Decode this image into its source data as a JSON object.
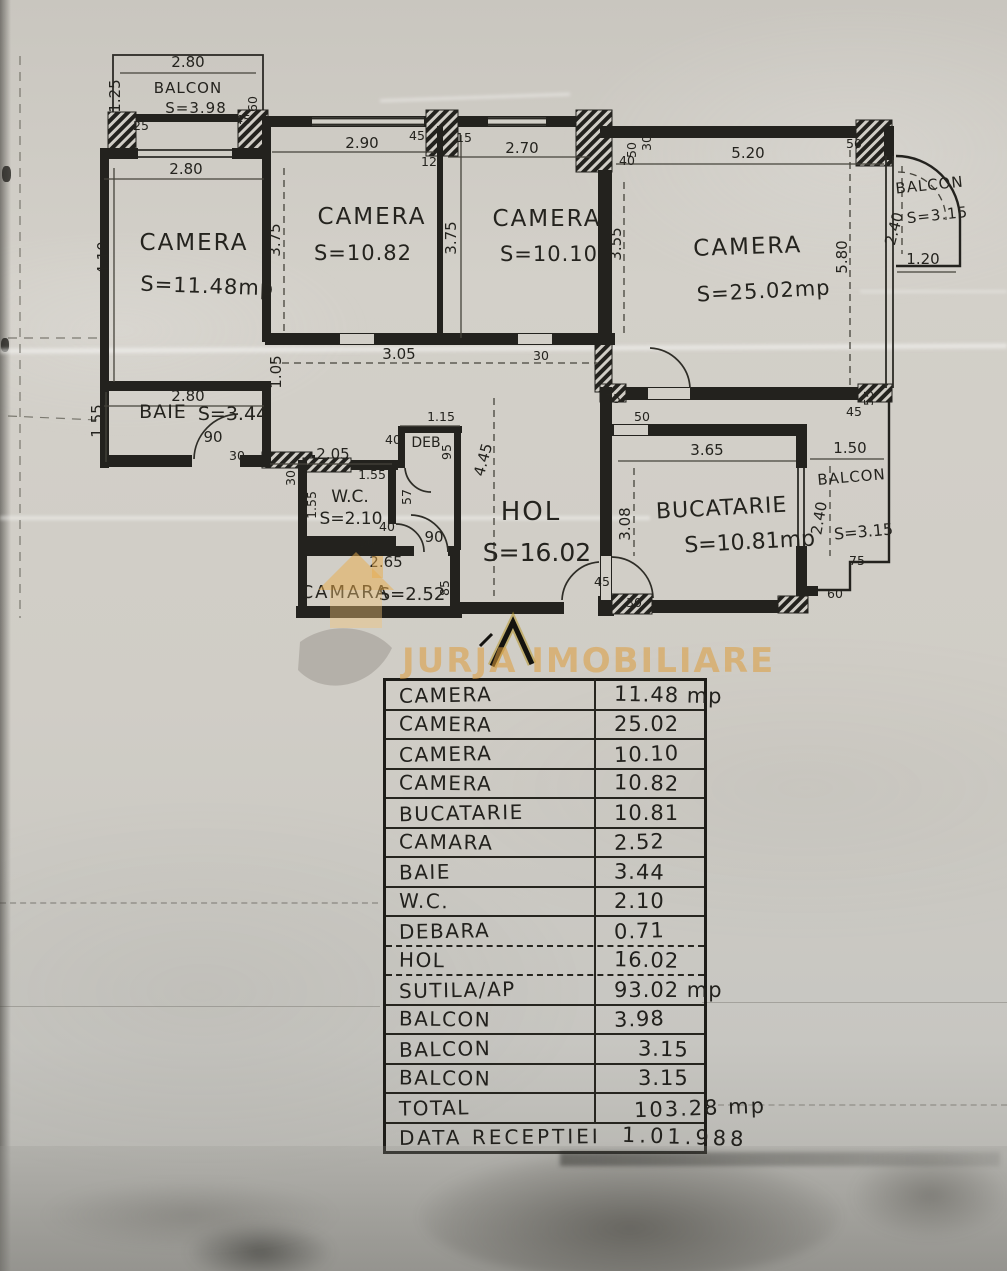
{
  "document": {
    "type_label": "apartment floor plan scan"
  },
  "watermark": {
    "brand": "JURJA IMOBILIARE",
    "logo": "house-logo",
    "color": "#dc9c3c"
  },
  "plan": {
    "rooms": [
      {
        "name": "BALCON",
        "area": "S=3.98"
      },
      {
        "name": "CAMERA",
        "area": "S=11.48mp"
      },
      {
        "name": "CAMERA",
        "area": "S=10.82"
      },
      {
        "name": "CAMERA",
        "area": "S=10.10"
      },
      {
        "name": "CAMERA",
        "area": "S=25.02mp"
      },
      {
        "name": "BALCON",
        "area": "S=3.15"
      },
      {
        "name": "BAIE",
        "area": "S=3.44"
      },
      {
        "name": "W.C.",
        "area": "S=2.10"
      },
      {
        "name": "DEB",
        "area": ""
      },
      {
        "name": "HOL",
        "area": "S=16.02"
      },
      {
        "name": "BUCATARIE",
        "area": "S=10.81mp"
      },
      {
        "name": "CAMARA",
        "area": "S=2.52"
      },
      {
        "name": "BALCON",
        "area": "S=3.15"
      }
    ],
    "dims": [
      "2.80",
      "1.25",
      "45",
      "60",
      "25",
      "2.80",
      "4.10",
      "3.75",
      "2.90",
      "45",
      "15",
      "12",
      "3.75",
      "2.70",
      "40",
      "50",
      "5.20",
      "50",
      "30",
      "3.55",
      "5.80",
      "2.40",
      "1.20",
      "1.55",
      "2.80",
      "1.05",
      "90",
      "30",
      "3.05",
      "30",
      "2.05",
      "1.55",
      "1.55",
      "40",
      "30",
      "40",
      "1.15",
      "95",
      "4.45",
      "57",
      "90",
      "30",
      "2.65",
      "85",
      "75",
      "50",
      "3.65",
      "3.08",
      "1.50",
      "2.40",
      "75",
      "45",
      "30",
      "45",
      "55",
      "60"
    ]
  },
  "table": {
    "rows": [
      {
        "label": "CAMERA",
        "value": "11.48 mp"
      },
      {
        "label": "CAMERA",
        "value": "25.02"
      },
      {
        "label": "CAMERA",
        "value": "10.10"
      },
      {
        "label": "CAMERA",
        "value": "10.82"
      },
      {
        "label": "BUCATARIE",
        "value": "10.81"
      },
      {
        "label": "CAMARA",
        "value": "2.52"
      },
      {
        "label": "BAIE",
        "value": "3.44"
      },
      {
        "label": "W.C.",
        "value": "2.10"
      },
      {
        "label": "DEBARA",
        "value": "0.71"
      },
      {
        "label": "HOL",
        "value": "16.02"
      },
      {
        "label": "SUTILA/AP",
        "value": "93.02 mp"
      },
      {
        "label": "BALCON",
        "value": "3.98"
      },
      {
        "label": "BALCON",
        "value": "3.15"
      },
      {
        "label": "BALCON",
        "value": "3.15"
      },
      {
        "label": "TOTAL",
        "value": "103.28 mp"
      },
      {
        "label": "DATA RECEPTIEI",
        "value": "1.01.988"
      }
    ]
  }
}
